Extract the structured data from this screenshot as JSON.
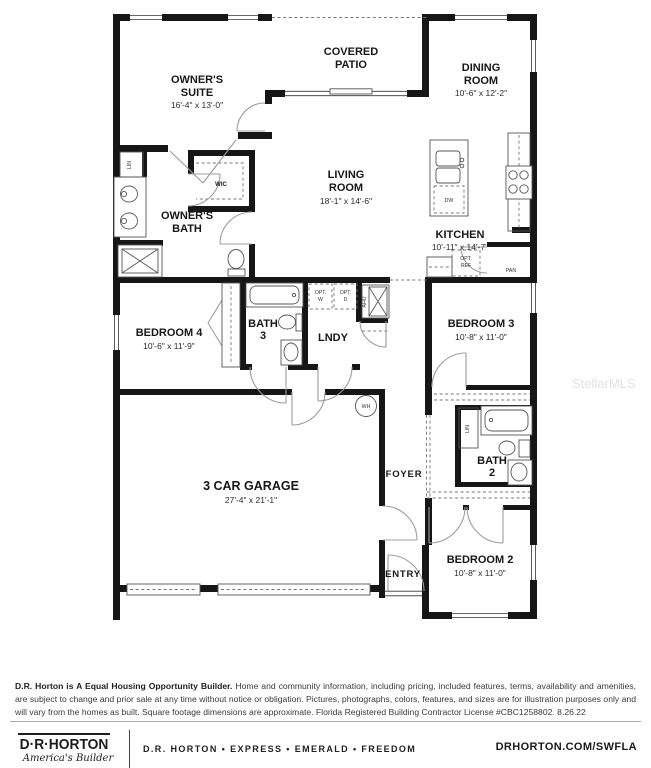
{
  "watermark": "StellarMLS",
  "plan": {
    "owners_suite": {
      "l1": "OWNER'S",
      "l2": "SUITE",
      "dims": "16'-4\" x 13'-0\""
    },
    "covered_patio": {
      "l1": "COVERED",
      "l2": "PATIO"
    },
    "dining_room": {
      "l1": "DINING",
      "l2": "ROOM",
      "dims": "10'-6\" x 12'-2\""
    },
    "living_room": {
      "l1": "LIVING",
      "l2": "ROOM",
      "dims": "18'-1\" x 14'-6\""
    },
    "kitchen": {
      "l1": "KITCHEN",
      "dims": "10'-11\" x 14'-7\""
    },
    "owners_bath": {
      "l1": "OWNER'S",
      "l2": "BATH"
    },
    "wic": "WIC",
    "lin1": "LIN",
    "lin2": "LIN",
    "bedroom4": {
      "l1": "BEDROOM 4",
      "dims": "10'-6\" x 11'-9\""
    },
    "bath3": {
      "l1": "BATH",
      "l2": "3"
    },
    "lndy": "LNDY",
    "opt_w": {
      "l1": "OPT.",
      "l2": "W"
    },
    "opt_d": {
      "l1": "OPT.",
      "l2": "D"
    },
    "ahu": "AHU",
    "dw": "DW",
    "opt_ref": {
      "l1": "OPT.",
      "l2": "REF"
    },
    "pan": "PAN",
    "bedroom3": {
      "l1": "BEDROOM 3",
      "dims": "10'-8\" x 11'-0\""
    },
    "garage": {
      "l1": "3 CAR GARAGE",
      "dims": "27'-4\" x 21'-1\""
    },
    "foyer": "FOYER",
    "wh": "WH",
    "bath2": {
      "l1": "BATH",
      "l2": "2"
    },
    "entry": "ENTRY",
    "bedroom2": {
      "l1": "BEDROOM 2",
      "dims": "10'-8\" x 11'-0\""
    }
  },
  "disclaimer": {
    "bold": "D.R. Horton is A Equal Housing Opportunity Builder.",
    "text": " Home and community information, including pricing, included features, terms, availability and amenities, are subject to change and prior sale at any time without notice or obligation. Pictures, photographs, colors, features, and sizes are for illustration purposes only and will vary from the homes as built. Square footage dimensions are approximate.  Florida Registered Building Contractor License #CBC1258802.  8.26.22"
  },
  "footer": {
    "logo_name": "D·R·HORTON",
    "logo_tagline": "America's Builder",
    "brands": "D.R. HORTON • EXPRESS • EMERALD • FREEDOM",
    "website": "DRHORTON.COM/SWFLA"
  },
  "colors": {
    "wall": "#161616",
    "watermark": "#e2e2e2"
  }
}
